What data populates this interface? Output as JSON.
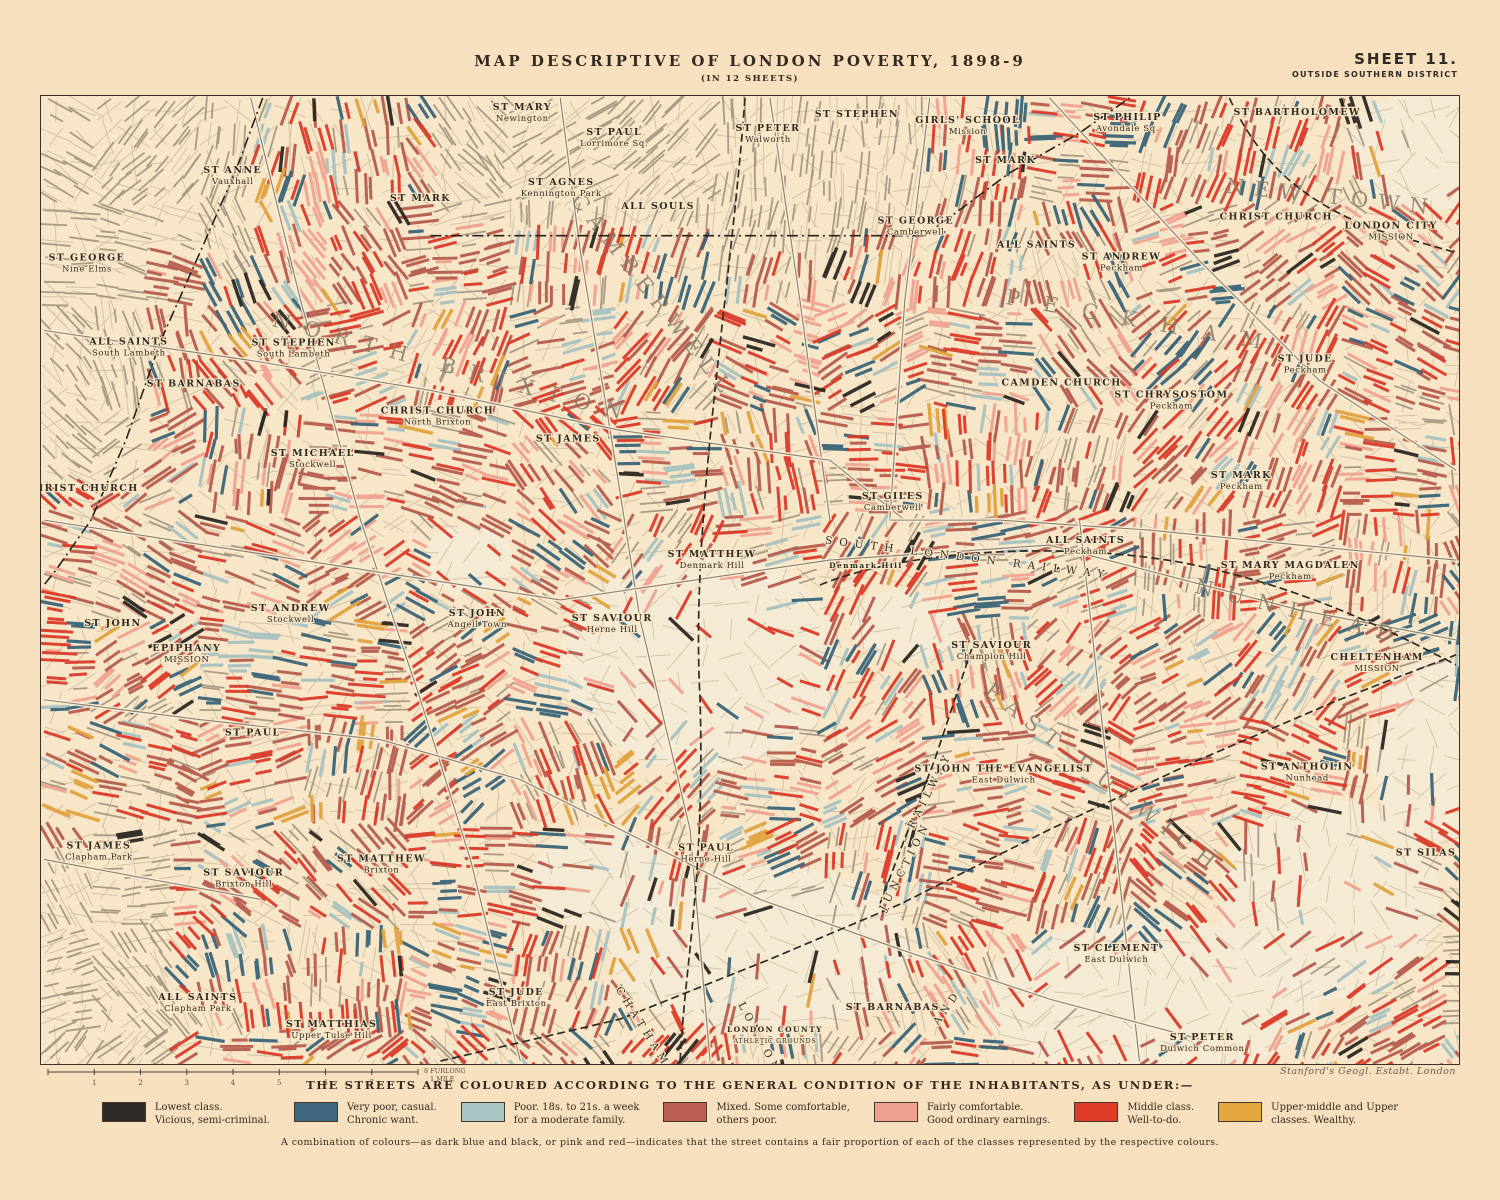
{
  "header": {
    "title": "MAP  DESCRIPTIVE  OF  LONDON  POVERTY,  1898-9",
    "subtitle": "(IN 12 SHEETS)",
    "sheet": "SHEET  11.",
    "district": "OUTSIDE  SOUTHERN  DISTRICT"
  },
  "map": {
    "credit": "Stanford's Geogl. Estabt. London",
    "scale": {
      "ticks": [
        "1",
        "2",
        "3",
        "4",
        "5",
        "6",
        "7"
      ],
      "end_label": "8 FURLONGS",
      "mile_label": "1 MILE"
    },
    "labels": [
      {
        "name": "ST GEORGE",
        "sub": "Nine Elms",
        "x": 86,
        "y": 260
      },
      {
        "name": "ALL SAINTS",
        "sub": "South Lambeth",
        "x": 128,
        "y": 344
      },
      {
        "name": "ST BARNABAS",
        "sub": "",
        "x": 193,
        "y": 386
      },
      {
        "name": "ST ANNE",
        "sub": "Vauxhall",
        "x": 232,
        "y": 172
      },
      {
        "name": "ST MARK",
        "sub": "",
        "x": 420,
        "y": 200
      },
      {
        "name": "ST MARY",
        "sub": "Newington",
        "x": 522,
        "y": 109
      },
      {
        "name": "ST PAUL",
        "sub": "Lorrimore Sq.",
        "x": 614,
        "y": 134
      },
      {
        "name": "ST AGNES",
        "sub": "Kennington Park",
        "x": 561,
        "y": 184
      },
      {
        "name": "ALL SOULS",
        "sub": "",
        "x": 658,
        "y": 208
      },
      {
        "name": "ST PETER",
        "sub": "Walworth",
        "x": 768,
        "y": 130
      },
      {
        "name": "ST STEPHEN",
        "sub": "",
        "x": 857,
        "y": 116
      },
      {
        "name": "ST GEORGE",
        "sub": "Camberwell",
        "x": 916,
        "y": 223
      },
      {
        "name": "GIRLS' SCHOOL",
        "sub": "Mission",
        "x": 968,
        "y": 122
      },
      {
        "name": "ST MARK",
        "sub": "",
        "x": 1006,
        "y": 162
      },
      {
        "name": "ST PHILIP",
        "sub": "Avondale Sq.",
        "x": 1128,
        "y": 119
      },
      {
        "name": "ST BARTHOLOMEW",
        "sub": "",
        "x": 1298,
        "y": 114
      },
      {
        "name": "CHRIST CHURCH",
        "sub": "",
        "x": 1277,
        "y": 219
      },
      {
        "name": "LONDON CITY",
        "sub": "MISSION",
        "x": 1392,
        "y": 228
      },
      {
        "name": "ALL SAINTS",
        "sub": "",
        "x": 1037,
        "y": 247
      },
      {
        "name": "ST ANDREW",
        "sub": "Peckham",
        "x": 1122,
        "y": 259
      },
      {
        "name": "CAMDEN CHURCH",
        "sub": "",
        "x": 1062,
        "y": 385
      },
      {
        "name": "ST CHRYSOSTOM",
        "sub": "Peckham",
        "x": 1172,
        "y": 397
      },
      {
        "name": "ST JUDE",
        "sub": "Peckham",
        "x": 1306,
        "y": 361
      },
      {
        "name": "ST MARK",
        "sub": "Peckham",
        "x": 1242,
        "y": 478
      },
      {
        "name": "ALL SAINTS",
        "sub": "Peckham",
        "x": 1086,
        "y": 543
      },
      {
        "name": "ST MARY MAGDALEN",
        "sub": "Peckham",
        "x": 1291,
        "y": 568
      },
      {
        "name": "ST GILES",
        "sub": "Camberwell",
        "x": 893,
        "y": 499
      },
      {
        "name": "ST SAVIOUR",
        "sub": "Champion Hill",
        "x": 992,
        "y": 648
      },
      {
        "name": "ST MATTHEW",
        "sub": "Denmark Hill",
        "x": 712,
        "y": 557
      },
      {
        "name": "Denmark Hill",
        "sub": "",
        "x": 866,
        "y": 568,
        "minor": true
      },
      {
        "name": "ST SAVIOUR",
        "sub": "Herne Hill",
        "x": 612,
        "y": 621
      },
      {
        "name": "ST JOHN",
        "sub": "Angell Town",
        "x": 477,
        "y": 616
      },
      {
        "name": "CHRIST CHURCH",
        "sub": "North Brixton",
        "x": 437,
        "y": 413
      },
      {
        "name": "ST JAMES",
        "sub": "",
        "x": 568,
        "y": 441
      },
      {
        "name": "ST MICHAEL",
        "sub": "Stockwell",
        "x": 312,
        "y": 456
      },
      {
        "name": "ST STEPHEN",
        "sub": "South Lambeth",
        "x": 293,
        "y": 345
      },
      {
        "name": "ST ANDREW",
        "sub": "Stockwell",
        "x": 290,
        "y": 611
      },
      {
        "name": "CHRIST CHURCH",
        "sub": "",
        "x": 81,
        "y": 491
      },
      {
        "name": "ST JOHN",
        "sub": "",
        "x": 112,
        "y": 626
      },
      {
        "name": "EPIPHANY",
        "sub": "MISSION",
        "x": 186,
        "y": 651
      },
      {
        "name": "ST PAUL",
        "sub": "",
        "x": 252,
        "y": 736
      },
      {
        "name": "ST JAMES",
        "sub": "Clapham Park",
        "x": 98,
        "y": 849
      },
      {
        "name": "ST SAVIOUR",
        "sub": "Brixton Hill",
        "x": 243,
        "y": 876
      },
      {
        "name": "ST MATTHEW",
        "sub": "Brixton",
        "x": 381,
        "y": 862
      },
      {
        "name": "ALL SAINTS",
        "sub": "Clapham Park",
        "x": 197,
        "y": 1001
      },
      {
        "name": "ST MATTHIAS",
        "sub": "Upper Tulse Hill",
        "x": 331,
        "y": 1028
      },
      {
        "name": "ST JUDE",
        "sub": "East Brixton",
        "x": 516,
        "y": 996
      },
      {
        "name": "ST PAUL",
        "sub": "Herne Hill",
        "x": 706,
        "y": 851
      },
      {
        "name": "LONDON COUNTY",
        "sub": "ATHLETIC GROUNDS",
        "x": 775,
        "y": 1033,
        "minor": true
      },
      {
        "name": "ST BARNABAS",
        "sub": "",
        "x": 893,
        "y": 1011
      },
      {
        "name": "ST JOHN THE EVANGELIST",
        "sub": "East Dulwich",
        "x": 1004,
        "y": 772
      },
      {
        "name": "ST CLEMENT",
        "sub": "East Dulwich",
        "x": 1117,
        "y": 952
      },
      {
        "name": "ST PETER",
        "sub": "Dulwich Common",
        "x": 1203,
        "y": 1041
      },
      {
        "name": "ST ANTHOLIN",
        "sub": "Nunhead",
        "x": 1308,
        "y": 770
      },
      {
        "name": "CHELTENHAM",
        "sub": "MISSION",
        "x": 1378,
        "y": 660
      },
      {
        "name": "ST SILAS",
        "sub": "",
        "x": 1427,
        "y": 856
      }
    ],
    "districts": [
      {
        "text": "NORTH BRIXTON",
        "x": 452,
        "y": 374,
        "rot": 15,
        "ls": 14
      },
      {
        "text": "CAMBERWELL",
        "x": 648,
        "y": 300,
        "rot": 52,
        "ls": 9
      },
      {
        "text": "PECKHAM",
        "x": 1145,
        "y": 328,
        "rot": 10,
        "ls": 24
      },
      {
        "text": "NEW TOWN",
        "x": 1332,
        "y": 203,
        "rot": 6,
        "ls": 10
      },
      {
        "text": "NUNHEAD",
        "x": 1300,
        "y": 619,
        "rot": 14,
        "ls": 14
      },
      {
        "text": "EAST DULWICH",
        "x": 1100,
        "y": 785,
        "rot": 38,
        "ls": 10
      }
    ],
    "railway_labels": [
      {
        "text": "SOUTH LONDON RAILWAY",
        "x": 968,
        "y": 561,
        "rot": 7,
        "ls": 7
      },
      {
        "text": "LONDON",
        "x": 757,
        "y": 1041,
        "rot": 62,
        "ls": 5
      },
      {
        "text": "CHATHAM",
        "x": 640,
        "y": 1030,
        "rot": 58,
        "ls": 5
      },
      {
        "text": "AND",
        "x": 950,
        "y": 1010,
        "rot": -55,
        "ls": 5
      },
      {
        "text": "JUNCTION",
        "x": 908,
        "y": 868,
        "rot": -63,
        "ls": 5
      },
      {
        "text": "RAILWAY",
        "x": 933,
        "y": 792,
        "rot": -63,
        "ls": 5
      }
    ]
  },
  "legend": {
    "heading": "THE STREETS ARE COLOURED ACCORDING TO THE GENERAL CONDITION OF THE INHABITANTS, AS UNDER:—",
    "items": [
      {
        "color": "#2e2a26",
        "line1": "Lowest class.",
        "line2": "Vicious, semi-criminal."
      },
      {
        "color": "#3d687e",
        "line1": "Very poor, casual.",
        "line2": "Chronic want."
      },
      {
        "color": "#a8c4c3",
        "line1": "Poor.  18s. to 21s. a week",
        "line2": "for a moderate family."
      },
      {
        "color": "#bb5f50",
        "line1": "Mixed.  Some comfortable,",
        "line2": "others poor."
      },
      {
        "color": "#f0a28e",
        "line1": "Fairly comfortable.",
        "line2": "Good ordinary earnings."
      },
      {
        "color": "#e03a28",
        "line1": "Middle class.",
        "line2": "Well-to-do."
      },
      {
        "color": "#e5a53f",
        "line1": "Upper-middle and Upper",
        "line2": "classes.   Wealthy."
      }
    ],
    "note": "A combination of colours—as dark blue and black, or pink and red—indicates that the street contains a fair proportion of each of the classes represented by the respective colours."
  }
}
